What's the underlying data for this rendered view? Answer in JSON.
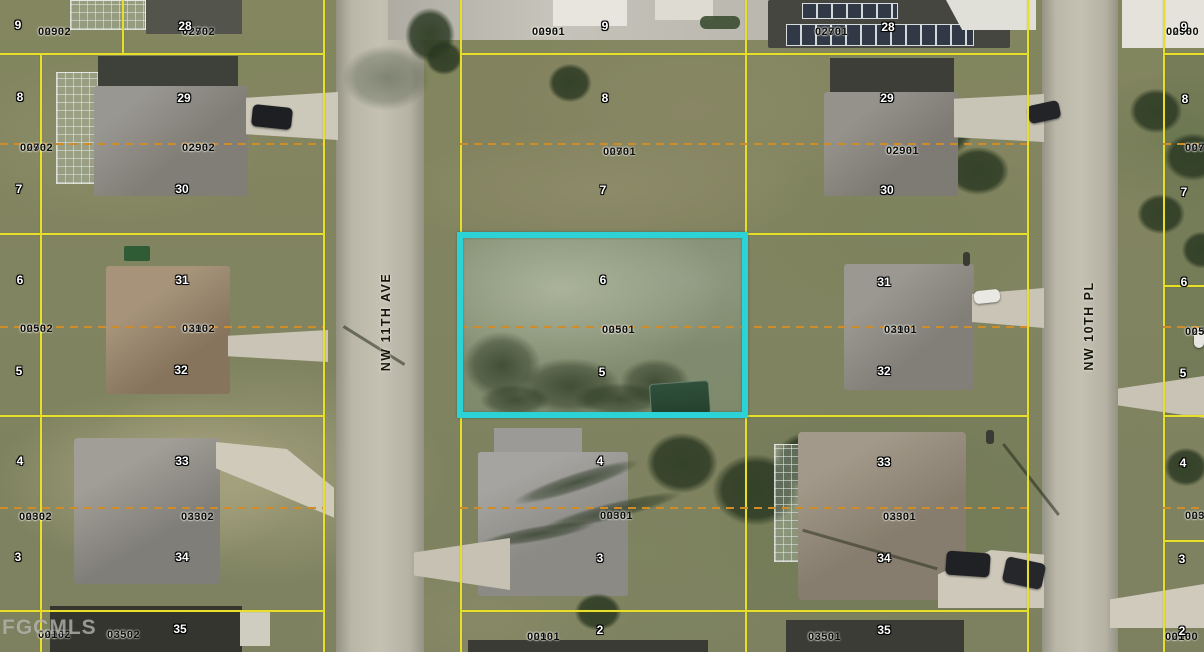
{
  "map": {
    "watermark": "FGCMLS",
    "highlight_parcel": {
      "parcel_id": "02931 0050"
    },
    "streets": [
      {
        "name": "NW 11TH AVE",
        "x": 386,
        "y": 322
      },
      {
        "name": "NW 10TH PL",
        "x": 1089,
        "y": 326
      }
    ],
    "colors": {
      "parcel_boundary_yellow": "#e8df2b",
      "lot_split_dash_orange": "#cf8c28",
      "highlight_cyan": "#2bd2d6",
      "road_gray": "#bcb9ab",
      "grass_olive": "#82855f"
    },
    "parcel_labels": [
      {
        "id1": "02932",
        "id2": "0090",
        "x": 38,
        "y": 27
      },
      {
        "id1": "02932",
        "id2": "0270",
        "x": 182,
        "y": 27
      },
      {
        "id1": "02931",
        "id2": "0090",
        "x": 532,
        "y": 27
      },
      {
        "id1": "02931",
        "id2": "0270",
        "x": 815,
        "y": 27
      },
      {
        "id1": "02930",
        "id2": "0090",
        "x": 1166,
        "y": 27
      },
      {
        "id1": "02932",
        "id2": "0070",
        "x": 20,
        "y": 143
      },
      {
        "id1": "02932",
        "id2": "0290",
        "x": 182,
        "y": 143
      },
      {
        "id1": "02931",
        "id2": "0070",
        "x": 603,
        "y": 147
      },
      {
        "id1": "02931",
        "id2": "0290",
        "x": 886,
        "y": 146
      },
      {
        "id1": "02930",
        "id2": "0070",
        "x": 1185,
        "y": 143
      },
      {
        "id1": "02932",
        "id2": "0050",
        "x": 20,
        "y": 324
      },
      {
        "id1": "02932",
        "id2": "0310",
        "x": 182,
        "y": 324
      },
      {
        "id1": "02931",
        "id2": "0050",
        "x": 602,
        "y": 325
      },
      {
        "id1": "02931",
        "id2": "0310",
        "x": 884,
        "y": 325
      },
      {
        "id1": "02930",
        "id2": "0050",
        "x": 1185,
        "y": 327
      },
      {
        "id1": "02932",
        "id2": "0030",
        "x": 19,
        "y": 512
      },
      {
        "id1": "02932",
        "id2": "0330",
        "x": 181,
        "y": 512
      },
      {
        "id1": "02931",
        "id2": "0030",
        "x": 600,
        "y": 511
      },
      {
        "id1": "02931",
        "id2": "0330",
        "x": 883,
        "y": 512
      },
      {
        "id1": "02930",
        "id2": "0030",
        "x": 1185,
        "y": 511
      },
      {
        "id1": "02932",
        "id2": "0010",
        "x": 38,
        "y": 630
      },
      {
        "id1": "02932",
        "id2": "0350",
        "x": 107,
        "y": 630
      },
      {
        "id1": "02931",
        "id2": "0010",
        "x": 527,
        "y": 632
      },
      {
        "id1": "02931",
        "id2": "0350",
        "x": 808,
        "y": 632
      },
      {
        "id1": "02930",
        "id2": "0010",
        "x": 1165,
        "y": 632
      }
    ],
    "lot_numbers": [
      {
        "n": "9",
        "x": 18,
        "y": 25
      },
      {
        "n": "28",
        "x": 185,
        "y": 26
      },
      {
        "n": "9",
        "x": 605,
        "y": 26
      },
      {
        "n": "28",
        "x": 888,
        "y": 27
      },
      {
        "n": "9",
        "x": 1184,
        "y": 27
      },
      {
        "n": "8",
        "x": 20,
        "y": 97
      },
      {
        "n": "7",
        "x": 19,
        "y": 189
      },
      {
        "n": "29",
        "x": 184,
        "y": 98
      },
      {
        "n": "30",
        "x": 182,
        "y": 189
      },
      {
        "n": "8",
        "x": 605,
        "y": 98
      },
      {
        "n": "7",
        "x": 603,
        "y": 190
      },
      {
        "n": "29",
        "x": 887,
        "y": 98
      },
      {
        "n": "30",
        "x": 887,
        "y": 190
      },
      {
        "n": "8",
        "x": 1185,
        "y": 99
      },
      {
        "n": "7",
        "x": 1184,
        "y": 192
      },
      {
        "n": "6",
        "x": 20,
        "y": 280
      },
      {
        "n": "5",
        "x": 19,
        "y": 371
      },
      {
        "n": "31",
        "x": 182,
        "y": 280
      },
      {
        "n": "32",
        "x": 181,
        "y": 370
      },
      {
        "n": "6",
        "x": 603,
        "y": 280
      },
      {
        "n": "5",
        "x": 602,
        "y": 372
      },
      {
        "n": "31",
        "x": 884,
        "y": 282
      },
      {
        "n": "32",
        "x": 884,
        "y": 371
      },
      {
        "n": "6",
        "x": 1184,
        "y": 282
      },
      {
        "n": "5",
        "x": 1183,
        "y": 373
      },
      {
        "n": "4",
        "x": 20,
        "y": 461
      },
      {
        "n": "3",
        "x": 18,
        "y": 557
      },
      {
        "n": "33",
        "x": 182,
        "y": 461
      },
      {
        "n": "34",
        "x": 182,
        "y": 557
      },
      {
        "n": "4",
        "x": 600,
        "y": 461
      },
      {
        "n": "3",
        "x": 600,
        "y": 558
      },
      {
        "n": "33",
        "x": 884,
        "y": 462
      },
      {
        "n": "34",
        "x": 884,
        "y": 558
      },
      {
        "n": "4",
        "x": 1183,
        "y": 463
      },
      {
        "n": "3",
        "x": 1182,
        "y": 559
      },
      {
        "n": "35",
        "x": 180,
        "y": 629
      },
      {
        "n": "2",
        "x": 600,
        "y": 630
      },
      {
        "n": "35",
        "x": 884,
        "y": 630
      },
      {
        "n": "2",
        "x": 1182,
        "y": 631
      }
    ]
  }
}
